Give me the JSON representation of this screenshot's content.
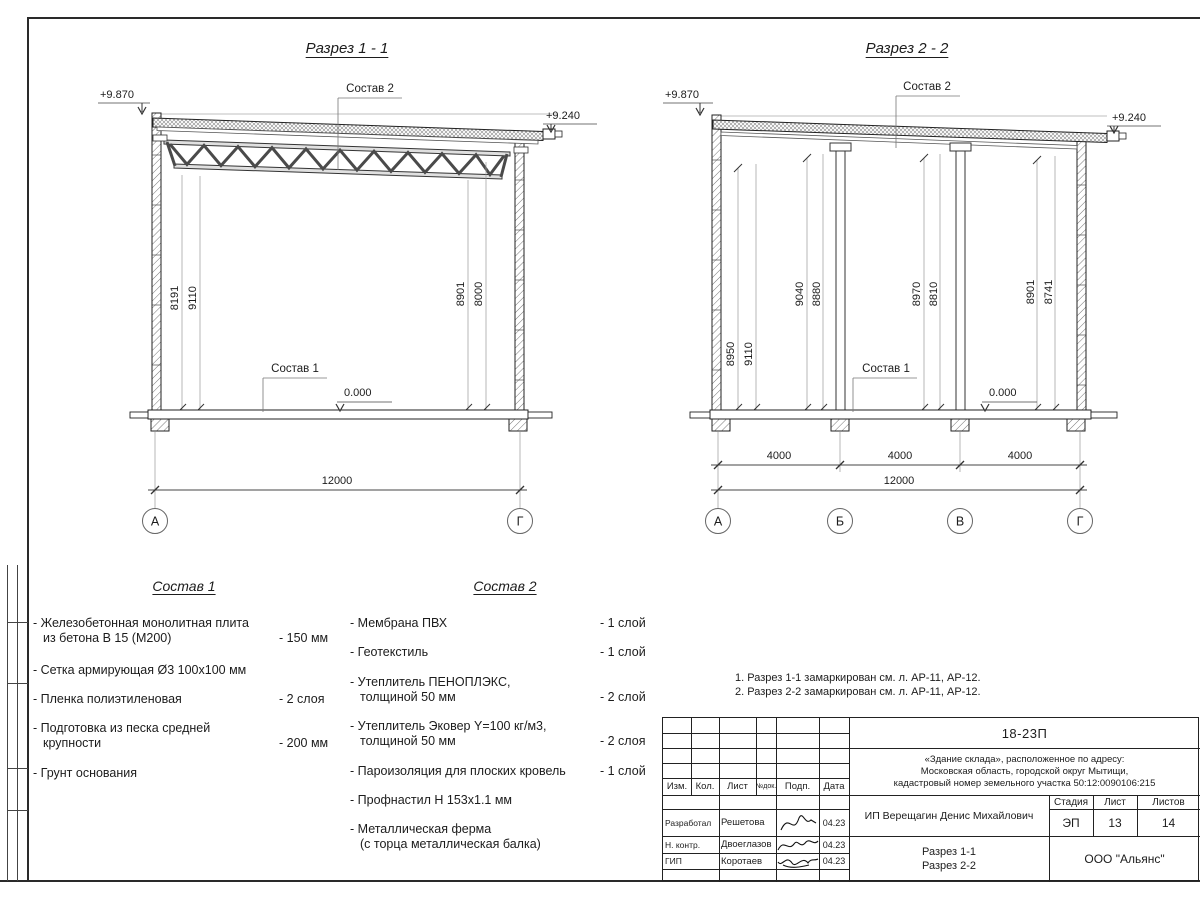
{
  "drawing": {
    "section1": {
      "title": "Разрез 1 - 1",
      "elev_top_left": "+9.870",
      "elev_top_right": "+9.240",
      "elev_floor": "0.000",
      "callout_roof": "Состав 2",
      "callout_floor": "Состав 1",
      "dim_left_a": "8191",
      "dim_left_b": "9110",
      "dim_right_a": "8901",
      "dim_right_b": "8000",
      "dim_total": "12000",
      "axis_left": "А",
      "axis_right": "Г"
    },
    "section2": {
      "title": "Разрез 2 - 2",
      "elev_top_left": "+9.870",
      "elev_top_right": "+9.240",
      "elev_floor": "0.000",
      "callout_roof": "Состав 2",
      "callout_floor": "Состав 1",
      "dims": [
        "8950",
        "9110",
        "9040",
        "8880",
        "8970",
        "8810",
        "8901",
        "8741"
      ],
      "dim_spans": [
        "4000",
        "4000",
        "4000"
      ],
      "dim_total": "12000",
      "axes": [
        "А",
        "Б",
        "В",
        "Г"
      ]
    }
  },
  "sostav1": {
    "title": "Состав 1",
    "items": [
      {
        "name": "- Железобетонная  монолитная плита\nиз бетона В 15 (М200)",
        "value": "- 150 мм"
      },
      {
        "name": "- Сетка армирующая Ø3 100х100 мм",
        "value": ""
      },
      {
        "name": "- Пленка полиэтиленовая",
        "value": "-  2 слоя"
      },
      {
        "name": "- Подготовка из песка средней\nкрупности",
        "value": "- 200 мм"
      },
      {
        "name": "- Грунт основания",
        "value": ""
      }
    ]
  },
  "sostav2": {
    "title": "Состав 2",
    "items": [
      {
        "name": "- Мембрана ПВХ",
        "value": "- 1 слой"
      },
      {
        "name": "- Геотекстиль",
        "value": "- 1 слой"
      },
      {
        "name": "- Утеплитель ПЕНОПЛЭКС,\nтолщиной 50 мм",
        "value": "- 2 слой"
      },
      {
        "name": "- Утеплитель Эковер Y=100 кг/м3,\nтолщиной 50 мм",
        "value": "- 2 слоя"
      },
      {
        "name": "- Пароизоляция для плоских кровель",
        "value": "- 1 слой"
      },
      {
        "name": "- Профнастил Н 153х1.1 мм",
        "value": ""
      },
      {
        "name": "- Металлическая ферма\n(с торца металлическая балка)",
        "value": ""
      }
    ]
  },
  "notes": {
    "line1": "1. Разрез 1-1 замаркирован см. л. АР-11, АР-12.",
    "line2": "2. Разрез 2-2 замаркирован см. л. АР-11, АР-12."
  },
  "titleblock": {
    "doc_number": "18-23П",
    "project": "«Здание склада», расположенное по адресу:\nМосковская область, городской округ Мытищи,\nкадастровый номер земельного участка 50:12:0090106:215",
    "client": "ИП Верещагин Денис Михайлович",
    "sheet_title": "Разрез 1-1\nРазрез 2-2",
    "company": "ООО \"Альянс\"",
    "cols": {
      "izm": "Изм.",
      "kol": "Кол.",
      "list": "Лист",
      "ndok": "№док.",
      "podp": "Подп.",
      "data": "Дата"
    },
    "stage_label": "Стадия",
    "sheet_label": "Лист",
    "sheets_label": "Листов",
    "stage": "ЭП",
    "sheet_no": "13",
    "sheets_total": "14",
    "rows": [
      {
        "role": "Разработал",
        "name": "Решетова",
        "date": "04.23"
      },
      {
        "role": "Н. контр.",
        "name": "Двоеглазов",
        "date": "04.23"
      },
      {
        "role": "ГИП",
        "name": "Коротаев",
        "date": "04.23"
      }
    ]
  }
}
